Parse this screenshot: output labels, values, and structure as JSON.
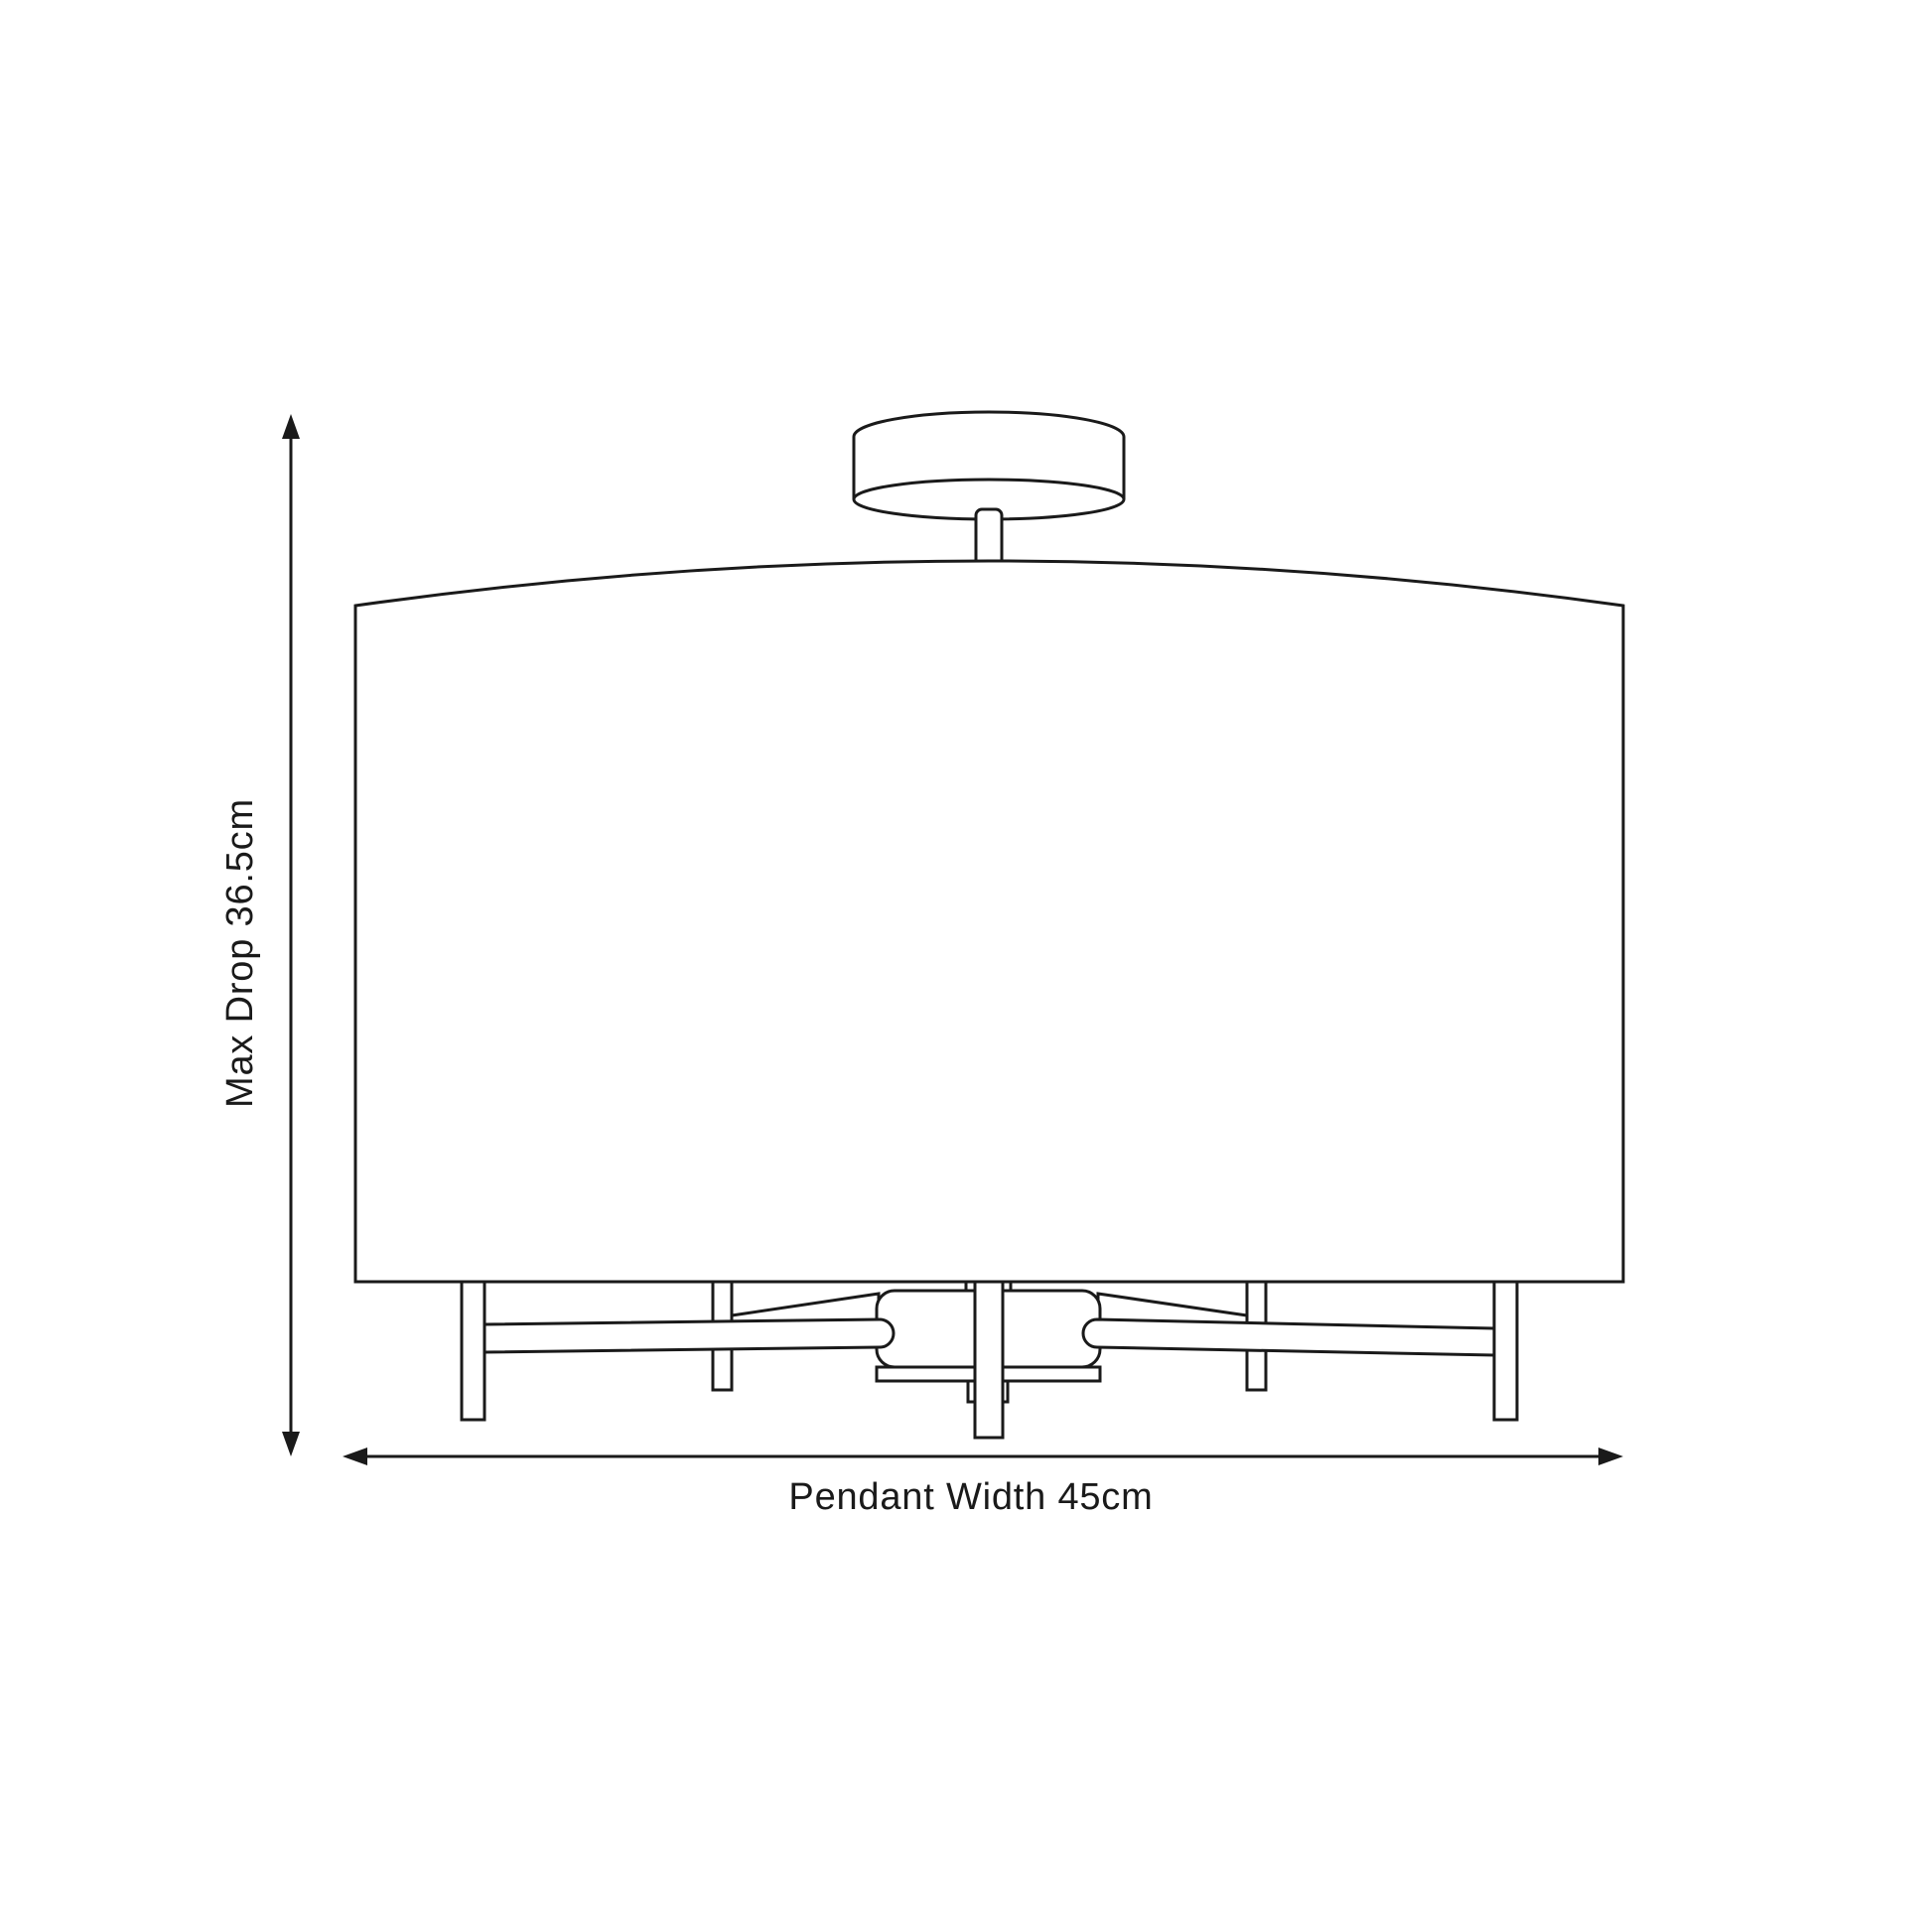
{
  "page": {
    "background_color": "#ffffff",
    "line_color": "#1a1a1a"
  },
  "diagram": {
    "subject": "ceiling-pendant-drum-shade-dimension-diagram",
    "dimensions": {
      "vertical": {
        "label": "Max Drop 36.5cm"
      },
      "horizontal": {
        "label": "Pendant Width 45cm"
      }
    },
    "parts": [
      "ceiling-canopy",
      "stem",
      "drum-shade",
      "central-hub",
      "lamp-arms",
      "lamp-holder-posts"
    ]
  }
}
